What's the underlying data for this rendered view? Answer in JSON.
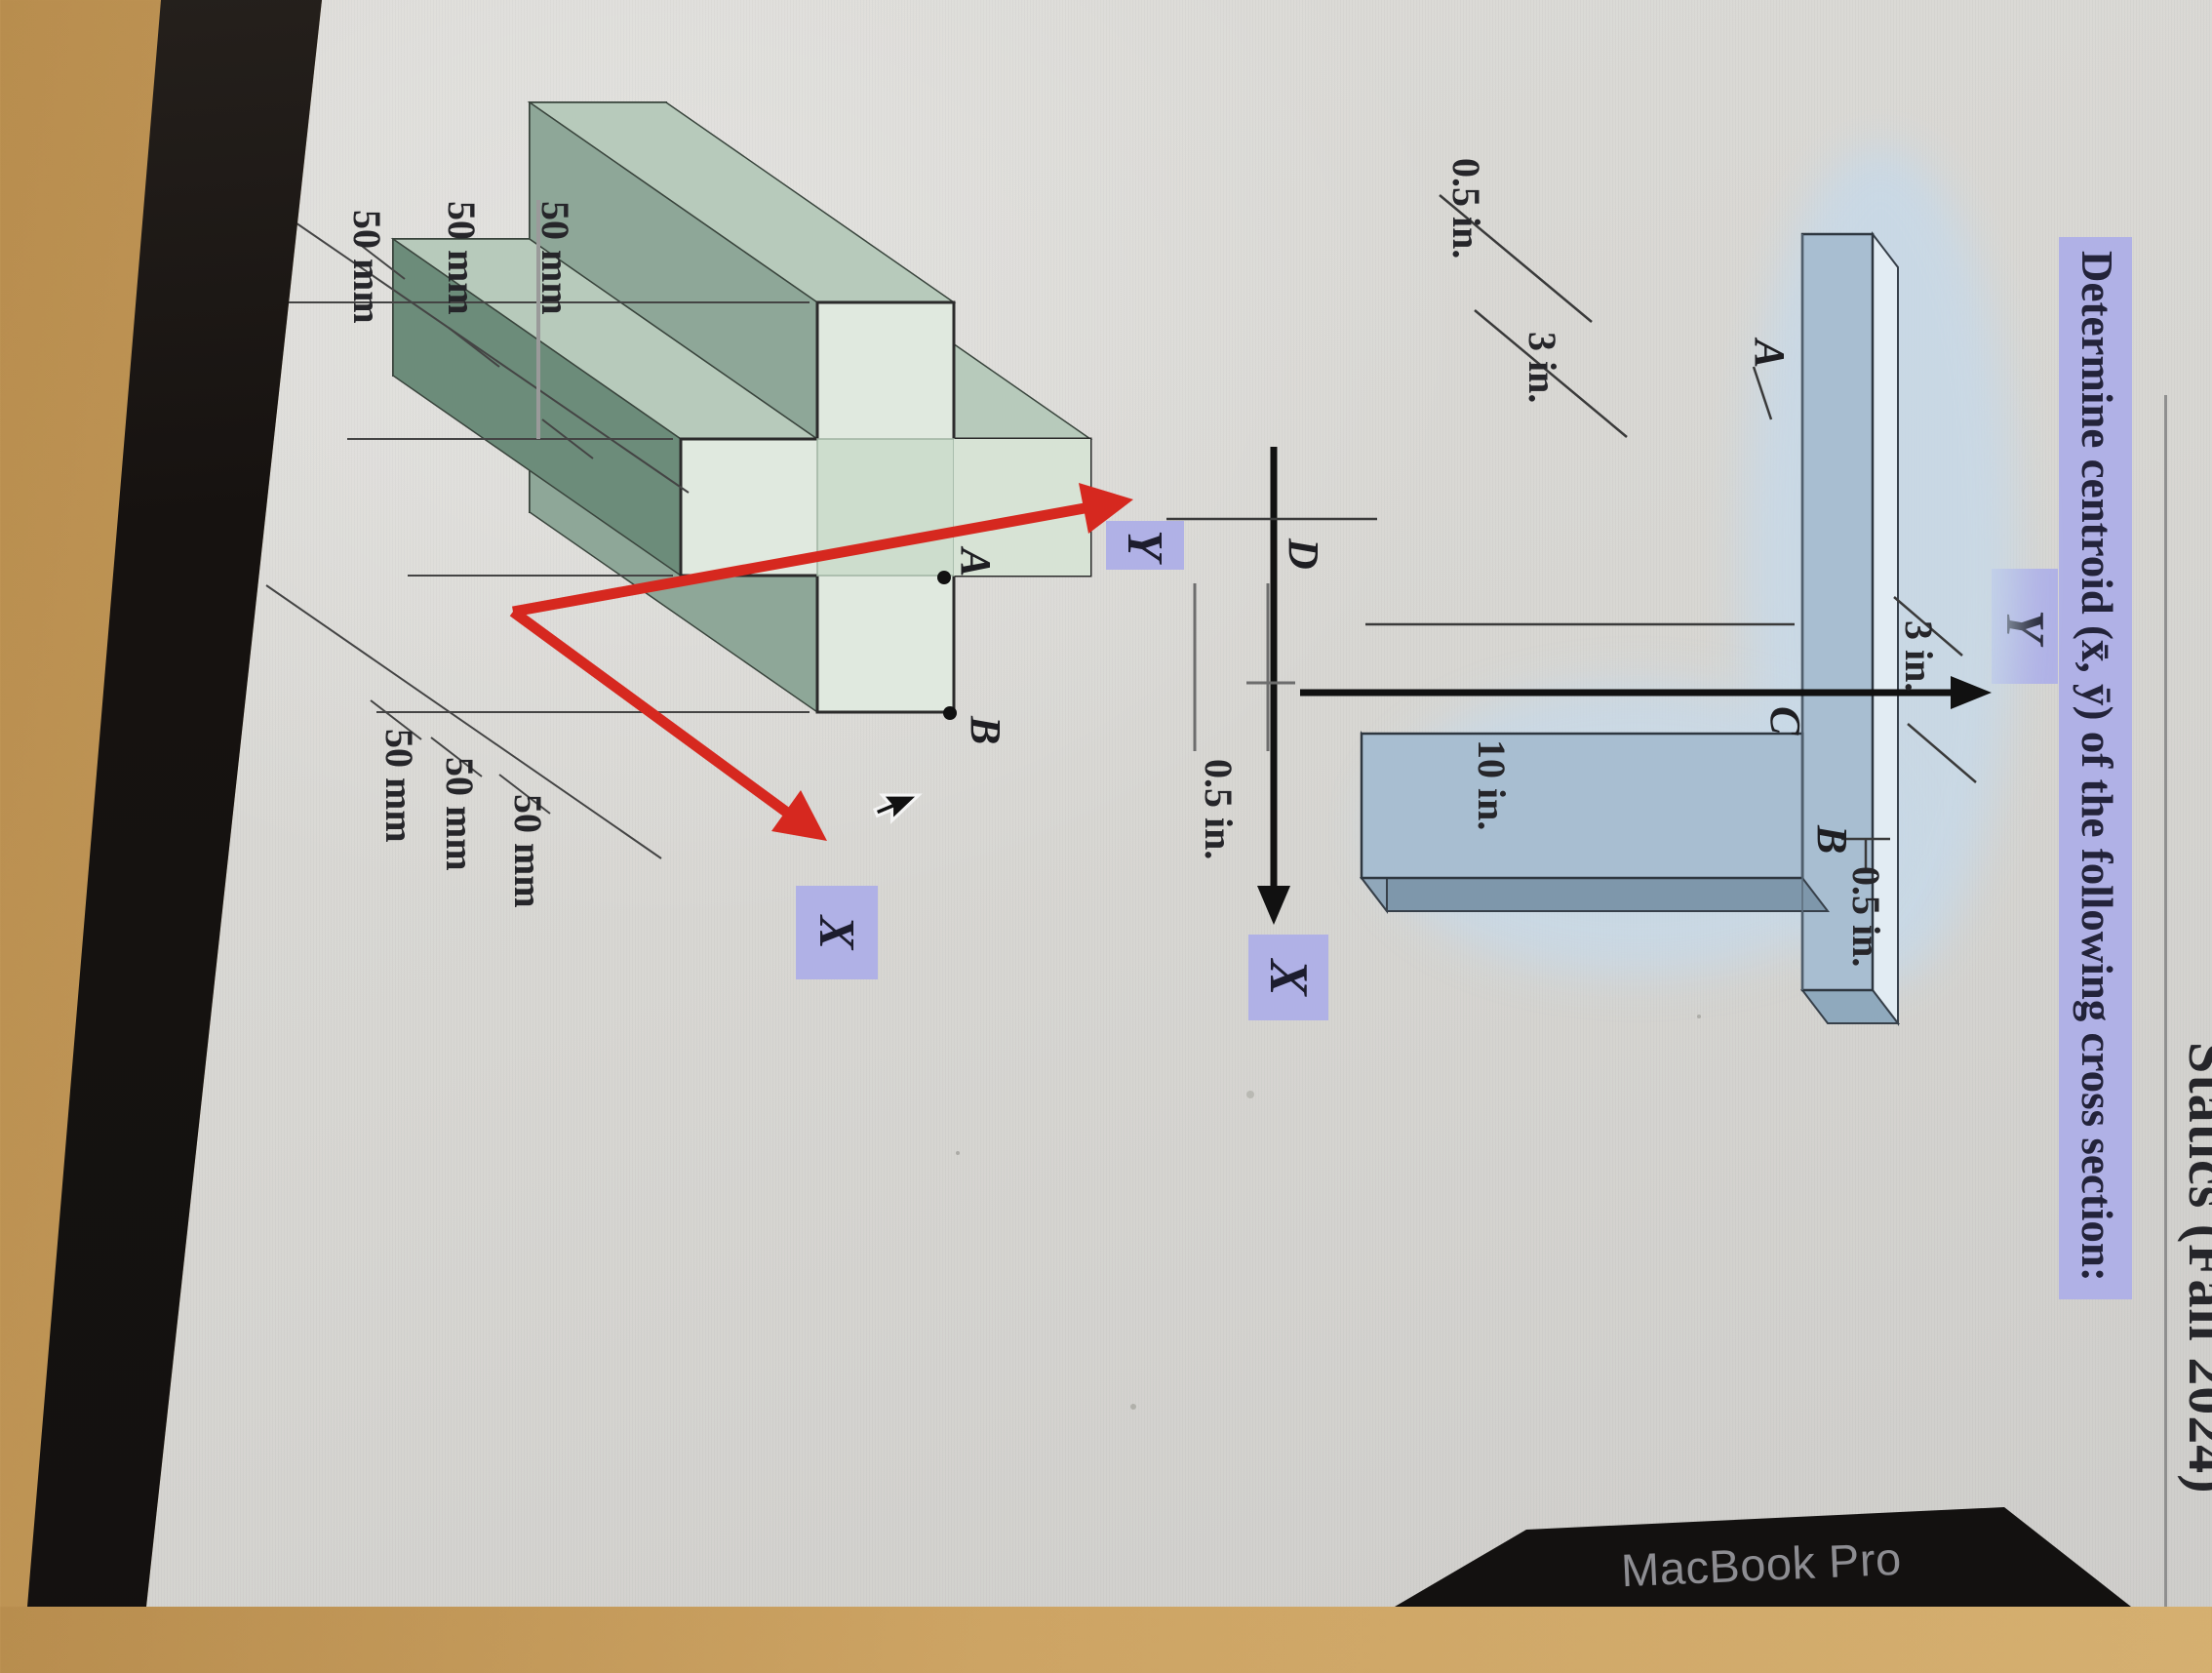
{
  "device": {
    "brand_label": "MacBook Pro"
  },
  "page": {
    "header": "Statics (Fall 2024)",
    "title": "Determine centroid (x̄, ȳ) of the following cross section:",
    "highlight_color": "#b0b1e6",
    "paper_color": "#d8d7d3"
  },
  "figure1": {
    "description": "blue 3D T-shaped beam cross section, inch units",
    "axes": {
      "x": "X",
      "y": "Y"
    },
    "points": {
      "a": "A",
      "b": "B",
      "c": "C",
      "d": "D"
    },
    "dims": [
      "0.5 in.",
      "3 in.",
      "3 in.",
      "10 in.",
      "0.5 in.",
      "0.5 in."
    ],
    "colors": {
      "plate": "#a8bed1",
      "top": "#e2ecf3",
      "side": "#7e97ab",
      "wash": "#c7d9e8"
    }
  },
  "figure2": {
    "description": "green 3D extruded plus-shaped cross section, mm units",
    "axes": {
      "x": "X",
      "y": "Y"
    },
    "points": {
      "a": "A",
      "b": "B"
    },
    "dims": [
      "50 mm",
      "50 mm",
      "50 mm",
      "50 mm",
      "50 mm",
      "50 mm"
    ],
    "colors": {
      "front": "#e0e9df",
      "band_dark": "#6c8c7a",
      "band_mid": "#8ea798",
      "band_light": "#b7cabb",
      "axis_red": "#d6281f"
    }
  }
}
